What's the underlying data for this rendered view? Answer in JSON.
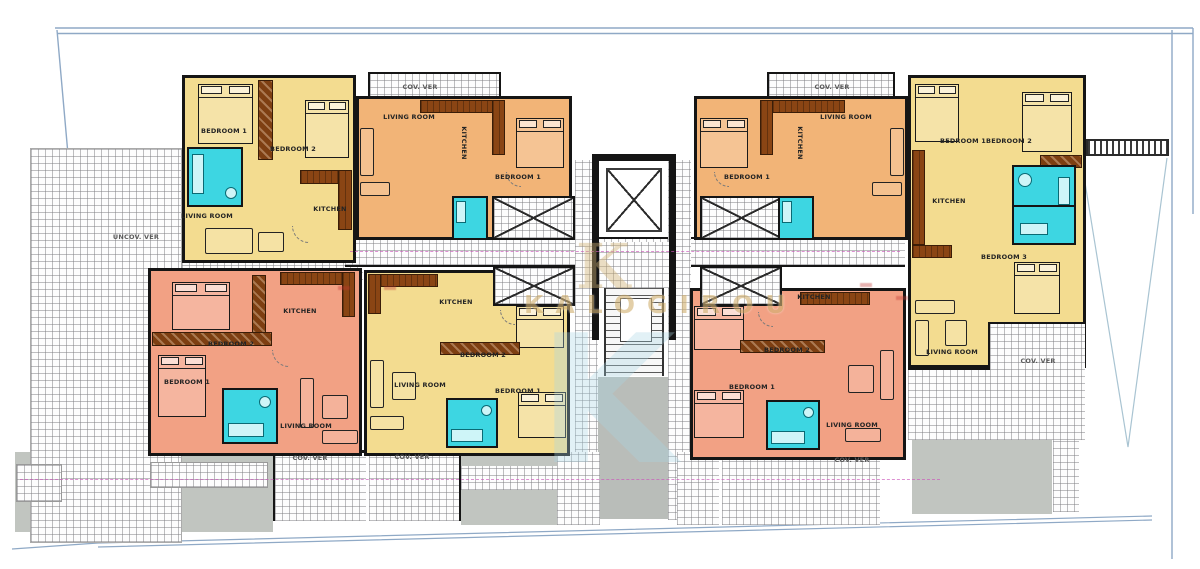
{
  "watermark": {
    "monogram": "K",
    "brand": "KALOGIROU",
    "big_letter": "K"
  },
  "site_labels": {
    "uncov_ver": "UNCOV. VER"
  },
  "room_labels": {
    "living_room": "LIVING ROOM",
    "kitchen": "KITCHEN",
    "bedroom_1": "BEDROOM 1",
    "bedroom_2": "BEDROOM 2",
    "bedroom_3": "BEDROOM 3",
    "cov_ver": "COV. VER"
  },
  "colors": {
    "unit_yellow": "#f3dc90",
    "unit_orange": "#f2b477",
    "unit_salmon": "#f2a184",
    "bathroom_cyan": "#3dd6e2",
    "furniture_brown": "#7e3f12",
    "wall_black": "#151515",
    "driveway_gray": "#c1c5c0",
    "boundary_blue": "#8fa9c6",
    "ramp_line_blue": "#a9c4d2",
    "centerline_magenta": "#cc55bb",
    "watermark_gold": "#d2b274",
    "watermark_blue": "#a9d6e6"
  }
}
